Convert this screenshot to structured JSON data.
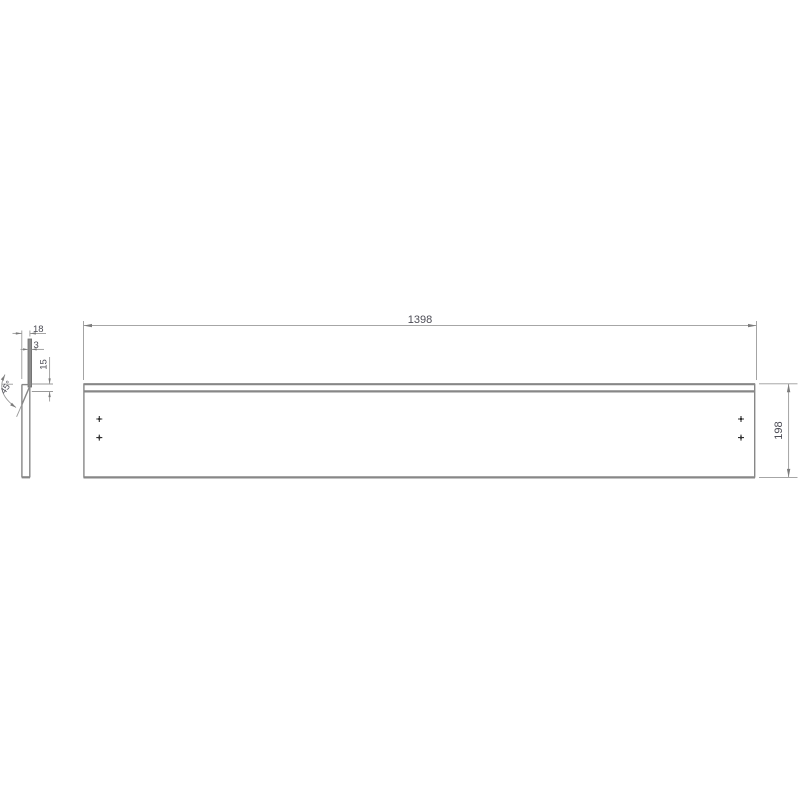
{
  "drawing": {
    "type": "technical-drawing",
    "part": {
      "length_label": "1398",
      "height_label": "198",
      "thickness_label": "18",
      "strip_thickness_label": "3",
      "groove_depth_label": "15",
      "chamfer_angle_label": "45°"
    },
    "views": {
      "front_view": "front elevation of panel",
      "side_view": "side section profile with chamfer and strip"
    },
    "hole_marks_count": 4,
    "colors": {
      "background": "#ffffff",
      "object_line": "#878787",
      "dimension_line": "#9a9a9a",
      "dimension_text": "#4c4c55",
      "hole_mark": "#2f2f2f",
      "strip_fill": "#8c8c8c"
    }
  }
}
